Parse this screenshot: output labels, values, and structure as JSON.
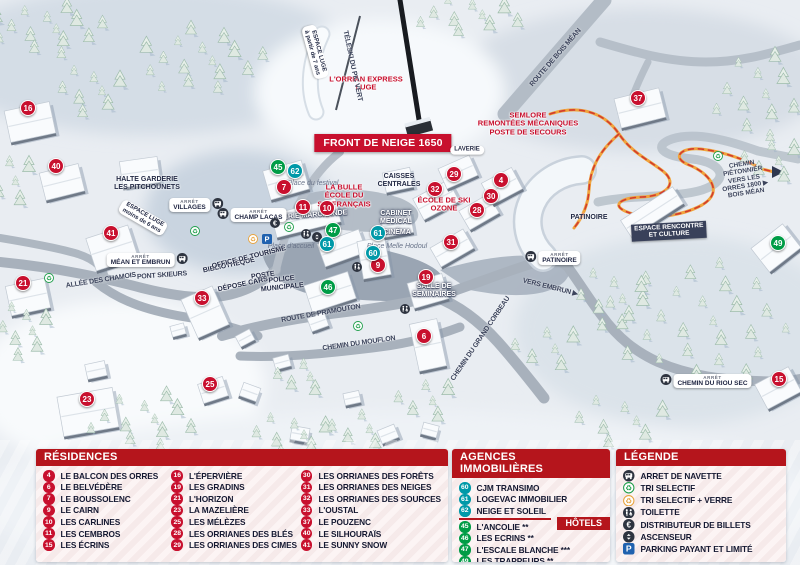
{
  "map": {
    "banner": "FRONT DE NEIGE 1650",
    "markers": [
      {
        "n": "16",
        "t": "r",
        "x": 28,
        "y": 108
      },
      {
        "n": "40",
        "t": "r",
        "x": 56,
        "y": 166
      },
      {
        "n": "41",
        "t": "r",
        "x": 111,
        "y": 233
      },
      {
        "n": "21",
        "t": "r",
        "x": 23,
        "y": 283
      },
      {
        "n": "23",
        "t": "r",
        "x": 87,
        "y": 399
      },
      {
        "n": "33",
        "t": "r",
        "x": 202,
        "y": 298
      },
      {
        "n": "25",
        "t": "r",
        "x": 210,
        "y": 384
      },
      {
        "n": "7",
        "t": "r",
        "x": 284,
        "y": 187
      },
      {
        "n": "11",
        "t": "r",
        "x": 303,
        "y": 207
      },
      {
        "n": "10",
        "t": "r",
        "x": 327,
        "y": 208
      },
      {
        "n": "9",
        "t": "r",
        "x": 378,
        "y": 265
      },
      {
        "n": "19",
        "t": "r",
        "x": 426,
        "y": 277
      },
      {
        "n": "6",
        "t": "r",
        "x": 424,
        "y": 336
      },
      {
        "n": "31",
        "t": "r",
        "x": 451,
        "y": 242
      },
      {
        "n": "32",
        "t": "r",
        "x": 435,
        "y": 189
      },
      {
        "n": "29",
        "t": "r",
        "x": 454,
        "y": 174
      },
      {
        "n": "28",
        "t": "r",
        "x": 477,
        "y": 210
      },
      {
        "n": "30",
        "t": "r",
        "x": 491,
        "y": 196
      },
      {
        "n": "4",
        "t": "r",
        "x": 501,
        "y": 180
      },
      {
        "n": "37",
        "t": "r",
        "x": 638,
        "y": 98
      },
      {
        "n": "15",
        "t": "r",
        "x": 779,
        "y": 379
      },
      {
        "n": "45",
        "t": "g",
        "x": 278,
        "y": 167
      },
      {
        "n": "47",
        "t": "g",
        "x": 333,
        "y": 230
      },
      {
        "n": "46",
        "t": "g",
        "x": 328,
        "y": 287
      },
      {
        "n": "49",
        "t": "g",
        "x": 778,
        "y": 243
      },
      {
        "n": "62",
        "t": "t",
        "x": 295,
        "y": 171
      },
      {
        "n": "61",
        "t": "t",
        "x": 327,
        "y": 244
      },
      {
        "n": "61",
        "t": "t",
        "x": 378,
        "y": 233
      },
      {
        "n": "60",
        "t": "t",
        "x": 373,
        "y": 253
      }
    ],
    "icons": [
      {
        "type": "recycle",
        "x": 49,
        "y": 279
      },
      {
        "type": "recycle",
        "x": 195,
        "y": 232
      },
      {
        "type": "recycle",
        "x": 289,
        "y": 228
      },
      {
        "type": "recycle",
        "x": 358,
        "y": 327
      },
      {
        "type": "recycle",
        "x": 718,
        "y": 157
      },
      {
        "type": "verre",
        "x": 253,
        "y": 240
      },
      {
        "type": "parking",
        "x": 267,
        "y": 240
      },
      {
        "type": "atm",
        "x": 275,
        "y": 224
      },
      {
        "type": "wc",
        "x": 306,
        "y": 235
      },
      {
        "type": "wc",
        "x": 357,
        "y": 268
      },
      {
        "type": "wc",
        "x": 405,
        "y": 310
      },
      {
        "type": "lift",
        "x": 317,
        "y": 238
      }
    ],
    "arrets": [
      {
        "tag": "ARRÊT",
        "name": "VILLAGES",
        "x": 196,
        "y": 205,
        "side": "right"
      },
      {
        "tag": "ARRÊT",
        "name": "CHAMP LACAS",
        "x": 252,
        "y": 215,
        "side": "left"
      },
      {
        "tag": "ARRÊT",
        "name": "MÉAN ET EMBRUN",
        "x": 147,
        "y": 260,
        "side": "right"
      },
      {
        "tag": "ARRÊT",
        "name": "PATINOIRE",
        "x": 553,
        "y": 258,
        "side": "left"
      },
      {
        "tag": "ARRÊT",
        "name": "CHEMIN DU RIOU SEC",
        "x": 706,
        "y": 381,
        "side": "left"
      }
    ],
    "labels": [
      {
        "text": "L'ORRIAN EXPRESS\nLUGE",
        "cls": "red",
        "x": 366,
        "y": 84
      },
      {
        "text": "SEMLORE\nREMONTÉES MÉCANIQUES\nPOSTE DE SECOURS",
        "cls": "red",
        "x": 528,
        "y": 124
      },
      {
        "text": "LA BULLE\nÉCOLE DU\nSKI FRANÇAIS",
        "cls": "red",
        "x": 344,
        "y": 196
      },
      {
        "text": "ÉCOLE DE SKI\nOZONE",
        "cls": "red",
        "x": 444,
        "y": 205
      },
      {
        "text": "HALTE GARDERIE\nLES PITCHOUNETS",
        "cls": "dark",
        "x": 147,
        "y": 184
      },
      {
        "text": "CAISSES\nCENTRALES",
        "cls": "dark",
        "x": 399,
        "y": 181
      },
      {
        "text": "PATINOIRE",
        "cls": "dark",
        "x": 589,
        "y": 218
      },
      {
        "text": "POSTE",
        "cls": "dark",
        "x": 263,
        "y": 276,
        "rot": -8
      },
      {
        "text": "BIBLIOTHÈQUE",
        "cls": "dark",
        "x": 229,
        "y": 266,
        "rot": -12
      },
      {
        "text": "OFFICE DE TOURISME",
        "cls": "dark",
        "x": 249,
        "y": 258,
        "rot": -14
      },
      {
        "text": "DÉPOSE CARS",
        "cls": "dark",
        "x": 243,
        "y": 285,
        "rot": -12
      },
      {
        "text": "POLICE\nMUNICIPALE",
        "cls": "dark",
        "x": 282,
        "y": 284,
        "rot": -6
      },
      {
        "text": "GALERIE MARCHANDE",
        "cls": "white",
        "x": 308,
        "y": 216,
        "rot": -4
      },
      {
        "text": "CABINET\nMÉDICAL",
        "cls": "white",
        "x": 396,
        "y": 218
      },
      {
        "text": "CINÉMA",
        "cls": "white",
        "x": 397,
        "y": 233
      },
      {
        "text": "SALLE DE\nSÉMINAIRES",
        "cls": "white",
        "x": 434,
        "y": 291
      },
      {
        "text": "ESPACE RENCONTRE\nET CULTURE",
        "cls": "darkbg",
        "x": 669,
        "y": 231,
        "rot": -3
      },
      {
        "text": "LAVERIE",
        "cls": "pill",
        "x": 467,
        "y": 150
      },
      {
        "text": "ALLÉE DES CHAMOIS",
        "cls": "road",
        "x": 101,
        "y": 281,
        "rot": -9
      },
      {
        "text": "PONT SKIEURS",
        "cls": "road",
        "x": 162,
        "y": 276,
        "rot": -4
      },
      {
        "text": "ROUTE DE PRAMOUTON",
        "cls": "road",
        "x": 321,
        "y": 314,
        "rot": -10
      },
      {
        "text": "CHEMIN DU MOUFLON",
        "cls": "road",
        "x": 359,
        "y": 344,
        "rot": -8
      },
      {
        "text": "CHEMIN DU GRAND CORBEAU",
        "cls": "road",
        "x": 481,
        "y": 339,
        "rot": -56
      },
      {
        "text": "TÉLÉSKI DU PIC VERT",
        "cls": "road",
        "x": 352,
        "y": 66,
        "rot": 78
      },
      {
        "text": "ROUTE DE BOIS MÉAN",
        "cls": "road",
        "x": 556,
        "y": 58,
        "rot": -49
      },
      {
        "text": "CHEMIN PIÉTONNIER\nVERS LES ORRES 1800 ▶\nBOIS MÉAN",
        "cls": "road-sm",
        "x": 744,
        "y": 179,
        "rot": -9
      },
      {
        "text": "VERS EMBRUN ▶",
        "cls": "road",
        "x": 550,
        "y": 288,
        "rot": 14
      },
      {
        "text": "Place du festival",
        "cls": "place",
        "x": 313,
        "y": 184
      },
      {
        "text": "Place d'accueil",
        "cls": "place",
        "x": 291,
        "y": 247
      },
      {
        "text": "Place Melle Hodoul",
        "cls": "place",
        "x": 397,
        "y": 247
      },
      {
        "text": "ESPACE LUGE\nà partir de 7 ans",
        "cls": "pill",
        "x": 315,
        "y": 52,
        "rot": 75
      },
      {
        "text": "ESPACE LUGE\nmoins de 6 ans",
        "cls": "pill",
        "x": 143,
        "y": 218,
        "rot": 30
      }
    ]
  },
  "panels": {
    "residences": {
      "title": "RÉSIDENCES",
      "items": [
        {
          "n": "4",
          "label": "LE BALCON DES ORRES"
        },
        {
          "n": "6",
          "label": "LE BELVÉDÈRE"
        },
        {
          "n": "7",
          "label": "LE BOUSSOLENC"
        },
        {
          "n": "9",
          "label": "LE CAIRN"
        },
        {
          "n": "10",
          "label": "LES CARLINES"
        },
        {
          "n": "11",
          "label": "LES CEMBROS"
        },
        {
          "n": "15",
          "label": "LES ÉCRINS"
        },
        {
          "n": "16",
          "label": "L'ÉPERVIÈRE"
        },
        {
          "n": "19",
          "label": "LES GRADINS"
        },
        {
          "n": "21",
          "label": "L'HORIZON"
        },
        {
          "n": "23",
          "label": "LA MAZELIÈRE"
        },
        {
          "n": "25",
          "label": "LES MÉLÈZES"
        },
        {
          "n": "28",
          "label": "LES ORRIANES DES BLÉS"
        },
        {
          "n": "29",
          "label": "LES ORRIANES DES CIMES"
        },
        {
          "n": "30",
          "label": "LES ORRIANES DES FORÊTS"
        },
        {
          "n": "31",
          "label": "LES ORRIANES DES NEIGES"
        },
        {
          "n": "32",
          "label": "LES ORRIANES DES SOURCES"
        },
        {
          "n": "33",
          "label": "L'OUSTAL"
        },
        {
          "n": "37",
          "label": "LE POUZENC"
        },
        {
          "n": "40",
          "label": "LE SILHOURAÏS"
        },
        {
          "n": "41",
          "label": "LE SUNNY SNOW"
        }
      ]
    },
    "agences": {
      "title": "AGENCES IMMOBILIÈRES",
      "items": [
        {
          "n": "60",
          "label": "CJM TRANSIMO"
        },
        {
          "n": "61",
          "label": "LOGEVAC IMMOBILIER"
        },
        {
          "n": "62",
          "label": "NEIGE ET SOLEIL"
        }
      ]
    },
    "hotels": {
      "title": "HÔTELS",
      "items": [
        {
          "n": "45",
          "label": "L'ANCOLIE **"
        },
        {
          "n": "46",
          "label": "LES ECRINS **"
        },
        {
          "n": "47",
          "label": "L'ESCALE BLANCHE ***"
        },
        {
          "n": "49",
          "label": "LES TRAPPEURS **"
        }
      ]
    },
    "legende": {
      "title": "LÉGENDE",
      "items": [
        {
          "icon": "bus",
          "label": "ARRET DE NAVETTE"
        },
        {
          "icon": "recycle",
          "label": "TRI SELECTIF"
        },
        {
          "icon": "verre",
          "label": "TRI SELECTIF + VERRE"
        },
        {
          "icon": "wc",
          "label": "TOILETTE"
        },
        {
          "icon": "atm",
          "label": "DISTRIBUTEUR DE BILLETS"
        },
        {
          "icon": "lift",
          "label": "ASCENSEUR"
        },
        {
          "icon": "parking",
          "label": "PARKING PAYANT ET LIMITÉ"
        }
      ]
    }
  },
  "colors": {
    "residence_red": "#c8102e",
    "agency_teal": "#0099a8",
    "hotel_green": "#009c46",
    "header_red": "#b5151c",
    "navy_text": "#141831",
    "parking_blue": "#2062af",
    "verre_orange": "#e8a33d",
    "path_orange": "#f0a43c"
  }
}
